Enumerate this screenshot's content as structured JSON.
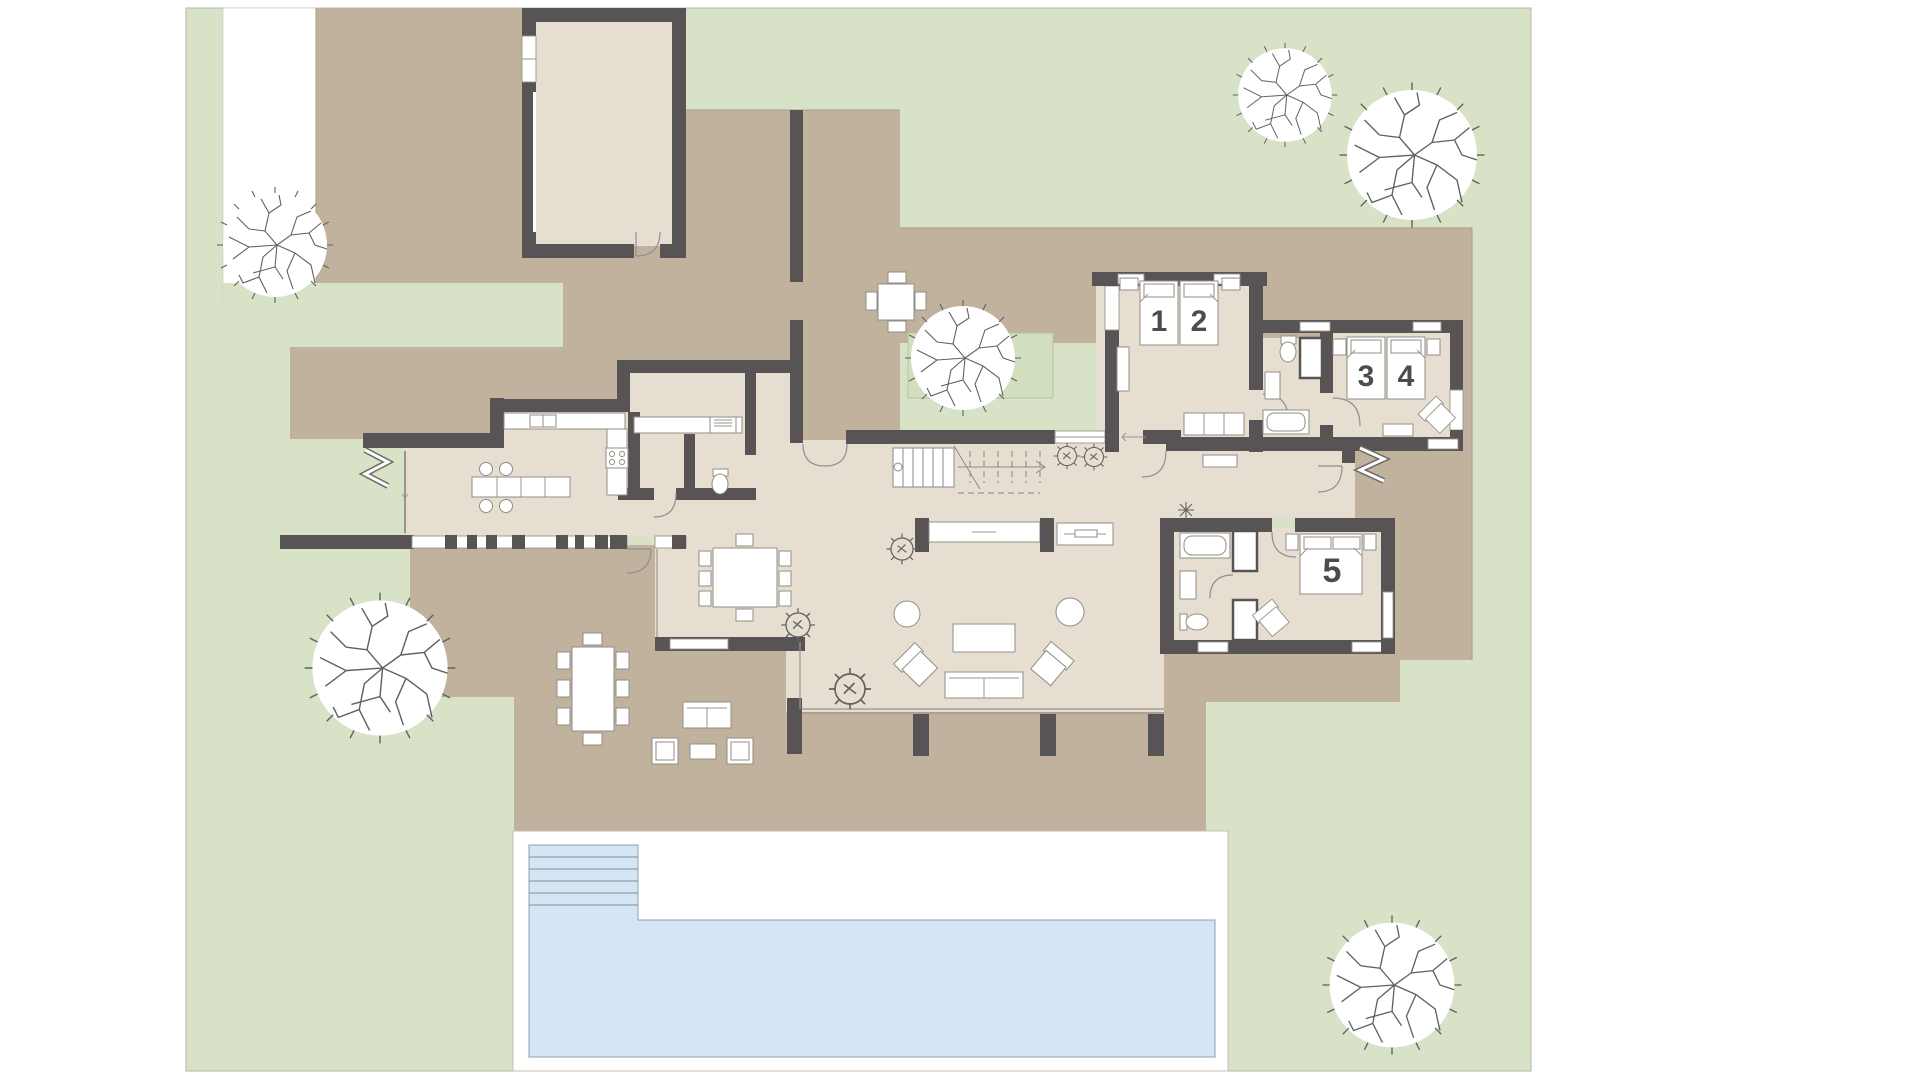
{
  "plan": {
    "type": "architectural-floor-plan",
    "beds": [
      "1",
      "2",
      "3",
      "4",
      "5"
    ],
    "features": [
      "garden",
      "driveway",
      "terrace",
      "courtyard",
      "garage",
      "kitchen",
      "pantry-laundry",
      "wc",
      "dining-area",
      "living-room",
      "stairs",
      "entry",
      "bedroom-1-2",
      "bathroom-1",
      "bedroom-3-4",
      "hallway",
      "bedroom-5",
      "bathroom-2",
      "pool",
      "pool-deck",
      "trees",
      "planting-beds",
      "outdoor-dining",
      "outdoor-lounge"
    ]
  },
  "colors": {
    "page_bg": "#ffffff",
    "garden": "#d7e2c6",
    "terrace": "#c1b29d",
    "floor": "#e6dfd1",
    "wall": "#585355",
    "pool_water": "#d4e5f6",
    "pool_edge": "#8fa0b0",
    "deck": "#ffffff",
    "planting_bed": "#d2dfbf",
    "furniture_fill": "#ffffff",
    "furniture_stroke": "#918d85",
    "label_color": "#4c4c4c",
    "tree_stroke": "#5f6163",
    "plan_border": "#b5b5a8",
    "driveway": "#ffffff"
  }
}
